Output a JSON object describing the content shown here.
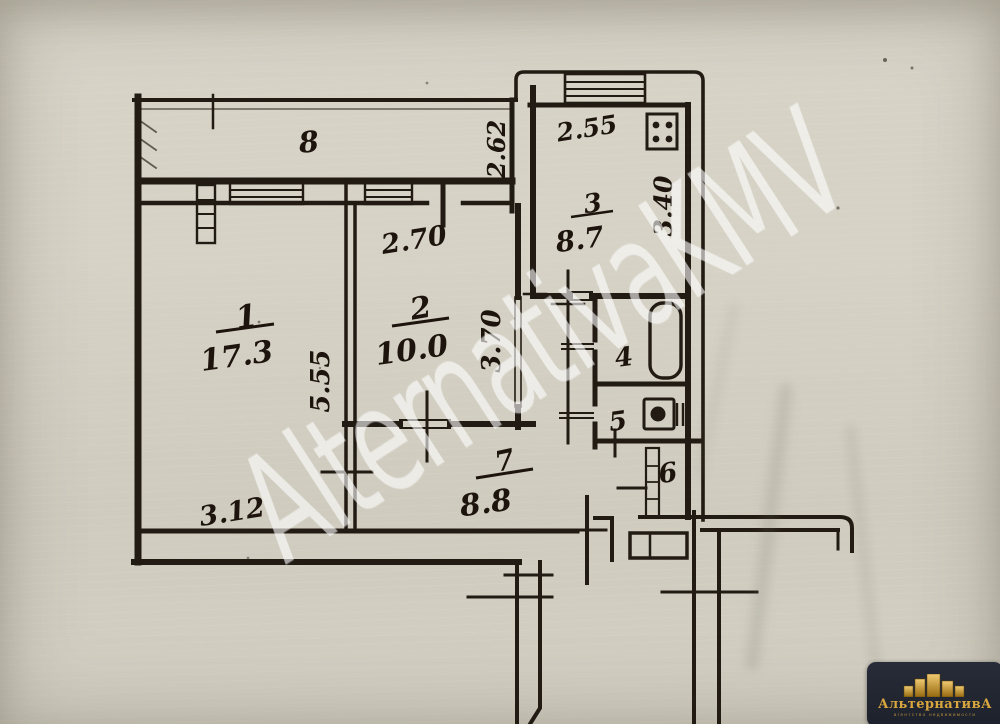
{
  "plan": {
    "rooms": {
      "living": {
        "num": "1",
        "area": "17.3"
      },
      "bedroom": {
        "num": "2",
        "area": "10.0"
      },
      "kitchen": {
        "num": "3",
        "area": "8.7"
      },
      "bath": {
        "num": "4"
      },
      "wc": {
        "num": "5"
      },
      "closet": {
        "num": "6"
      },
      "hall": {
        "num": "7",
        "area": "8.8"
      },
      "balcony": {
        "num": "8"
      }
    },
    "dims": {
      "room1_width": "3.12",
      "room1_depth": "5.55",
      "room2_width": "2.70",
      "room2_depth": "3.70",
      "kitchen_width": "2.55",
      "kitchen_depth": "3.40",
      "balcony_width": "2.62"
    }
  },
  "watermark": {
    "text": "AlternativaKMV"
  },
  "logo": {
    "title": "АльтернативА",
    "tagline": "агентство недвижимости"
  }
}
